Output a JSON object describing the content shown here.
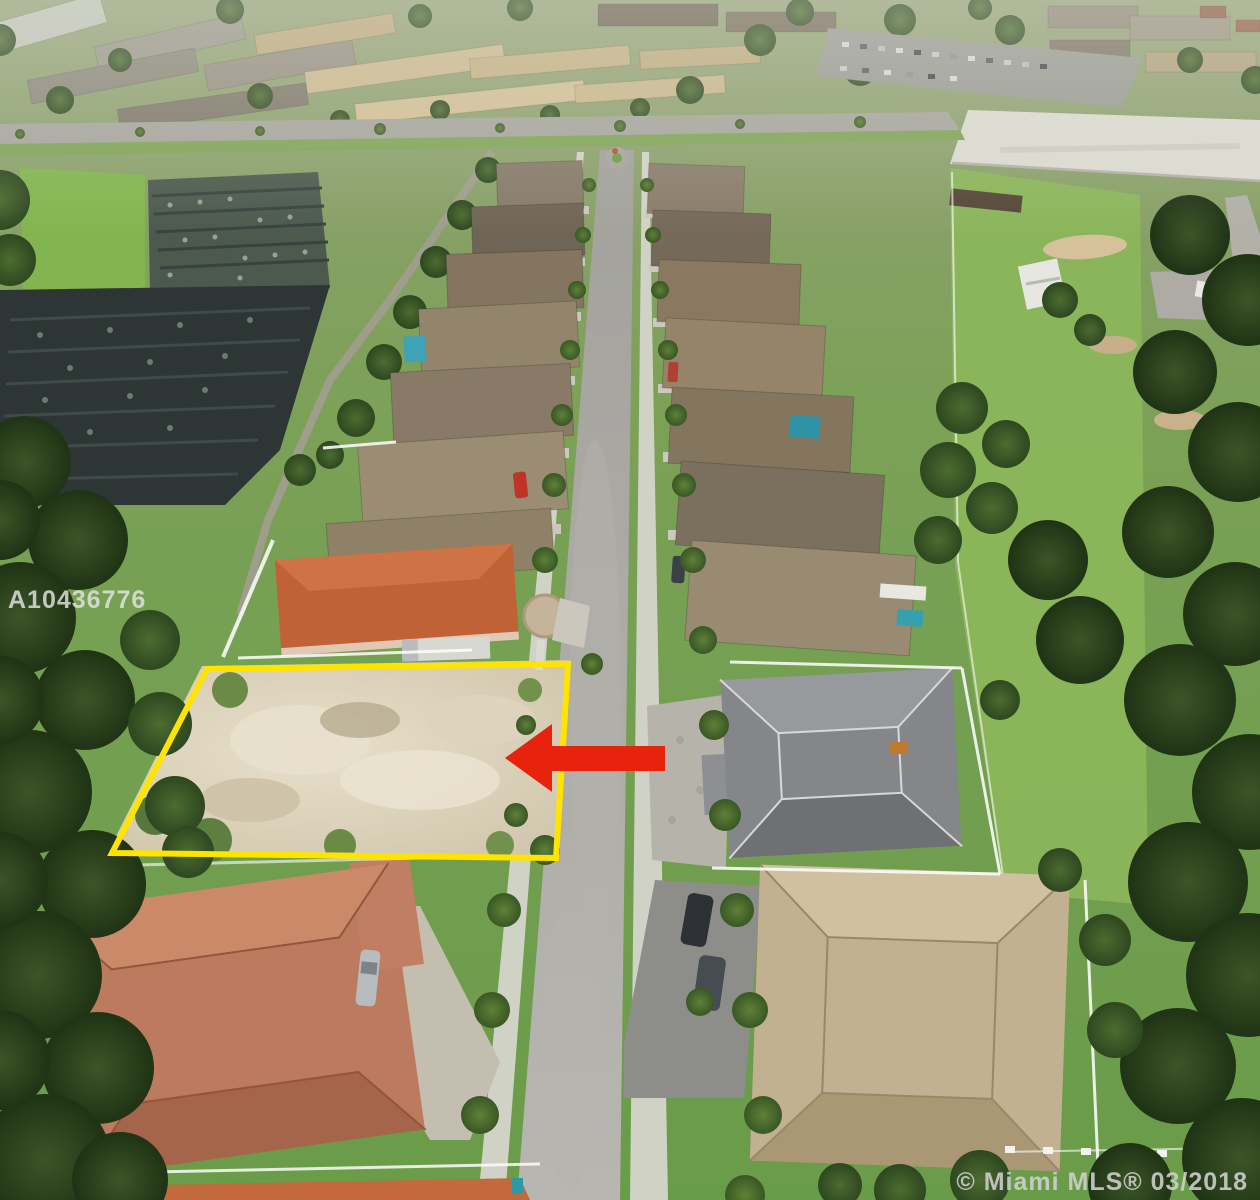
{
  "watermarks": {
    "mls_id": "A10436776",
    "copyright": "© Miami MLS® 03/2018"
  },
  "annotations": {
    "lot_outline": {
      "color": "#ffe400"
    },
    "arrow": {
      "color": "#e8230d"
    }
  }
}
